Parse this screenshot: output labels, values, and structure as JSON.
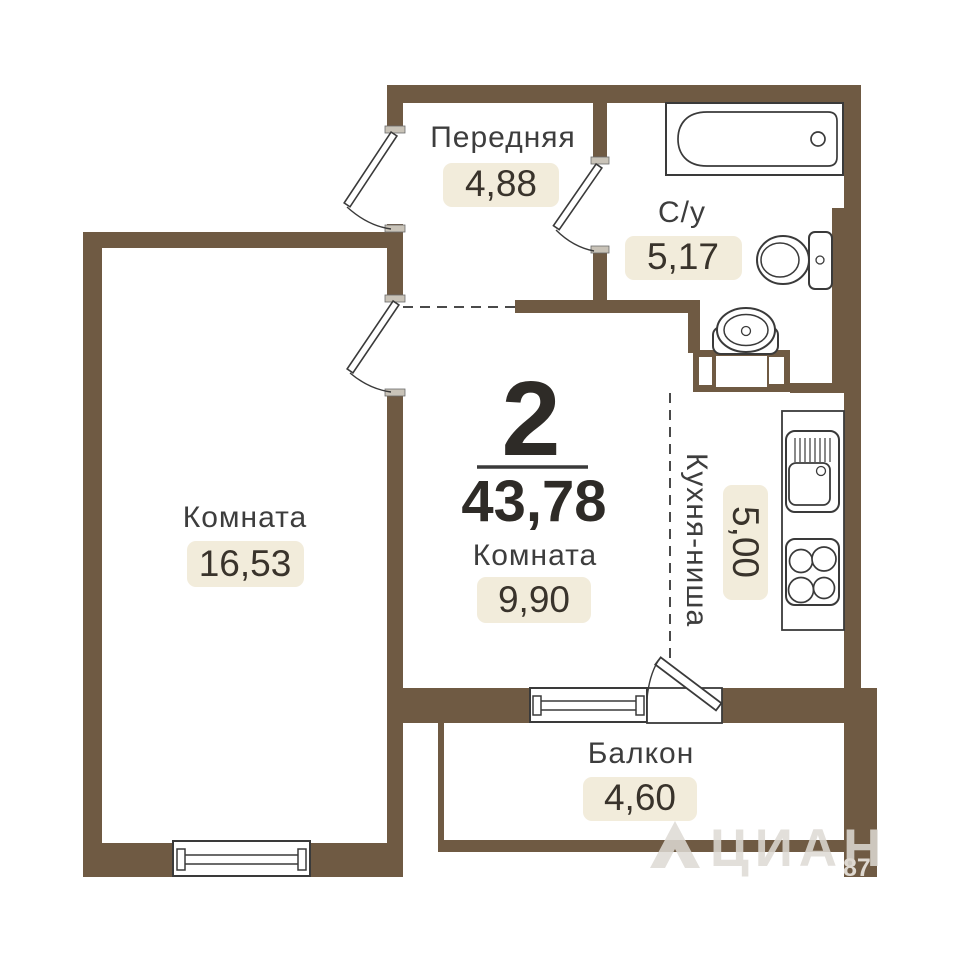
{
  "plan": {
    "unit": {
      "rooms_label": "2",
      "total_area": "43,78"
    },
    "rooms": [
      {
        "name": "Передняя",
        "area": "4,88"
      },
      {
        "name": "С/у",
        "area": "5,17"
      },
      {
        "name": "Комната",
        "area": "16,53"
      },
      {
        "name": "Комната",
        "area": "9,90"
      },
      {
        "name": "Кухня-ниша",
        "area": "5,00"
      },
      {
        "name": "Балкон",
        "area": "4,60"
      }
    ],
    "watermark": {
      "brand": "ЦИАН",
      "number": "87"
    },
    "colors": {
      "wall": "#6F5A43",
      "badge_bg": "#F2ECDB",
      "label_text": "#3D3D3D",
      "number_text": "#39332B",
      "line": "#3A3A3A"
    }
  }
}
